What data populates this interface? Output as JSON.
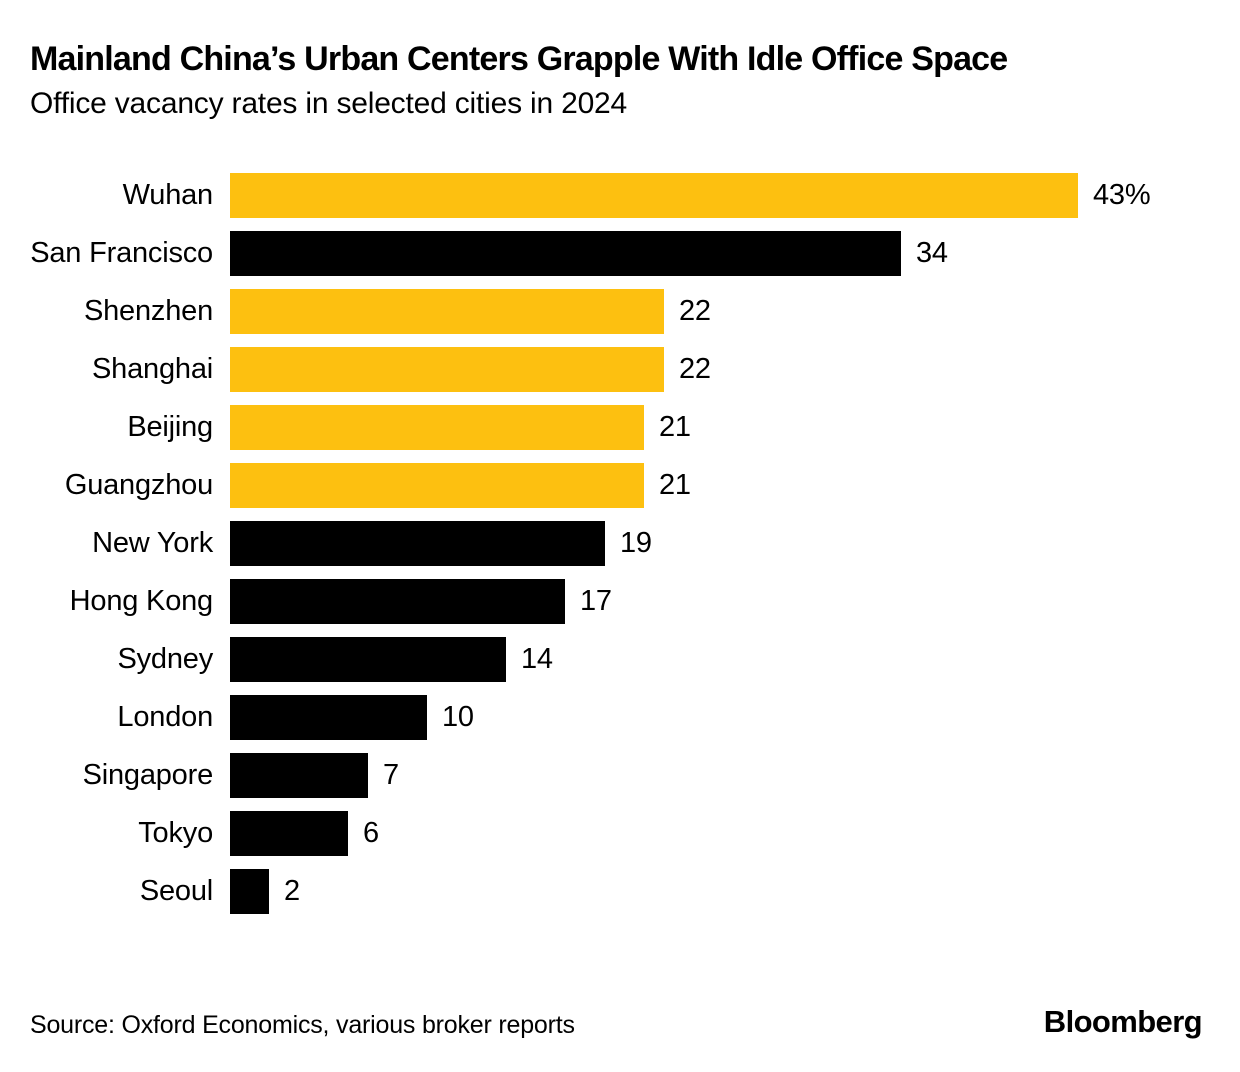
{
  "chart_data": {
    "type": "bar",
    "orientation": "horizontal",
    "title": "Mainland China’s Urban Centers Grapple With Idle Office Space",
    "subtitle": "Office vacancy rates in selected cities in 2024",
    "xlabel": "",
    "ylabel": "",
    "unit": "percent",
    "xlim": [
      0,
      43
    ],
    "grid": false,
    "legend": "none",
    "categories": [
      "Wuhan",
      "San Francisco",
      "Shenzhen",
      "Shanghai",
      "Beijing",
      "Guangzhou",
      "New York",
      "Hong Kong",
      "Sydney",
      "London",
      "Singapore",
      "Tokyo",
      "Seoul"
    ],
    "values": [
      43,
      34,
      22,
      22,
      21,
      21,
      19,
      17,
      14,
      10,
      7,
      6,
      2
    ],
    "value_labels": [
      "43%",
      "34",
      "22",
      "22",
      "21",
      "21",
      "19",
      "17",
      "14",
      "10",
      "7",
      "6",
      "2"
    ],
    "bar_colors": [
      "#FDC010",
      "#000000",
      "#FDC010",
      "#FDC010",
      "#FDC010",
      "#FDC010",
      "#000000",
      "#000000",
      "#000000",
      "#000000",
      "#000000",
      "#000000",
      "#000000"
    ],
    "colors": {
      "mainland_china_highlight": "#FDC010",
      "other_cities": "#000000",
      "background": "#FFFFFF",
      "text": "#000000"
    }
  },
  "footer": {
    "source": "Source: Oxford Economics, various broker reports",
    "brand": "Bloomberg"
  }
}
